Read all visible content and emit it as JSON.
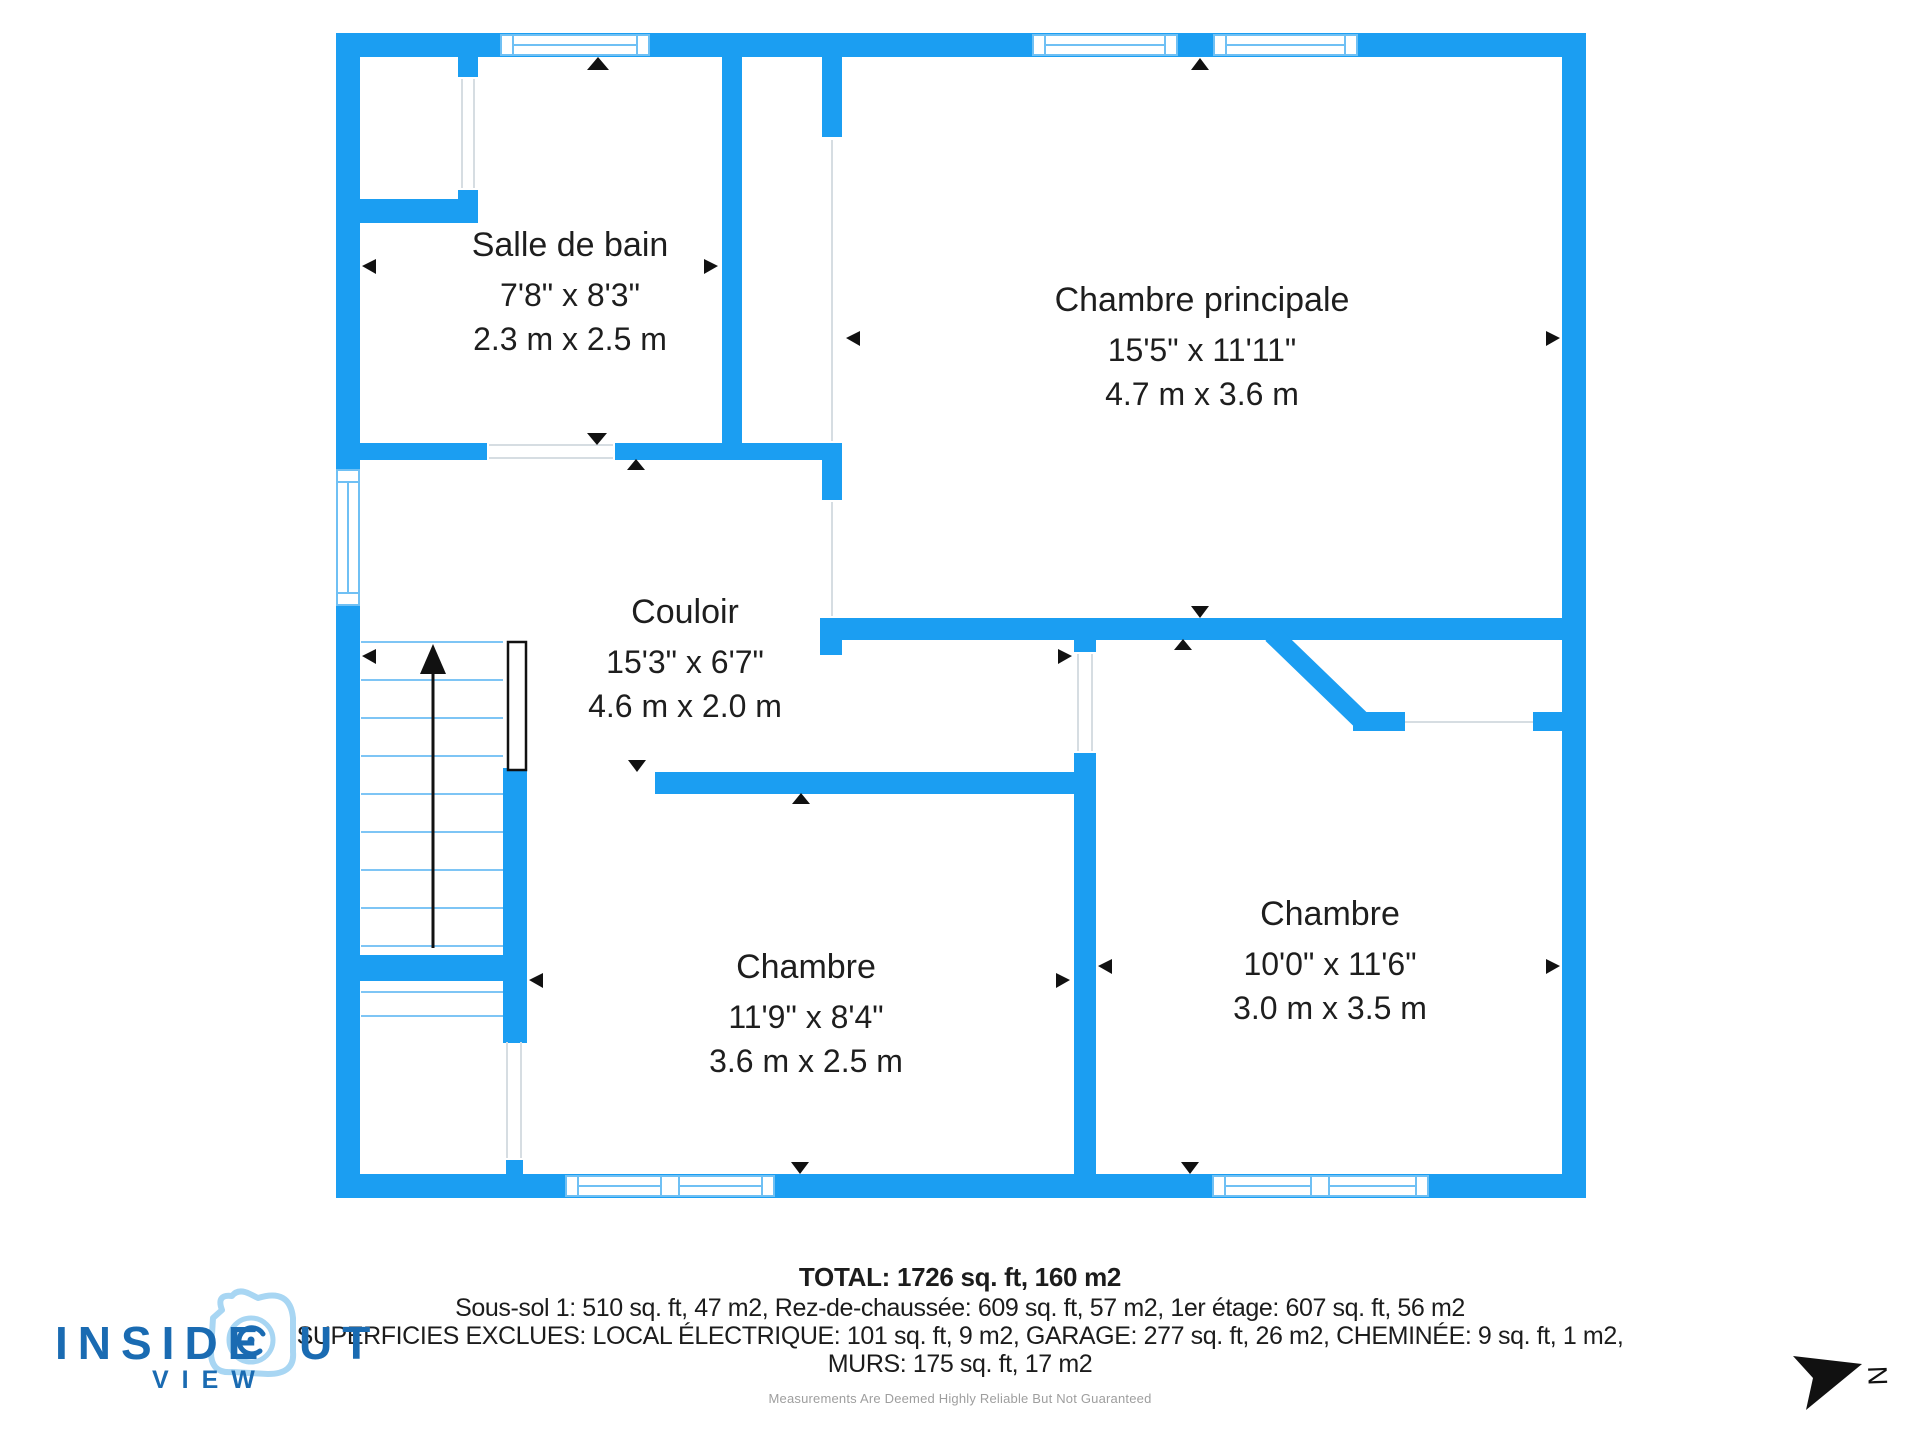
{
  "plan": {
    "rooms": [
      {
        "name": "Salle de bain",
        "imperial": "7'8\" x 8'3\"",
        "metric": "2.3 m x 2.5 m"
      },
      {
        "name": "Chambre principale",
        "imperial": "15'5\" x 11'11\"",
        "metric": "4.7 m x 3.6 m"
      },
      {
        "name": "Couloir",
        "imperial": "15'3\" x 6'7\"",
        "metric": "4.6 m x 2.0 m"
      },
      {
        "name": "Chambre",
        "imperial": "11'9\" x 8'4\"",
        "metric": "3.6 m x 2.5 m"
      },
      {
        "name": "Chambre",
        "imperial": "10'0\" x 11'6\"",
        "metric": "3.0 m x 3.5 m"
      }
    ]
  },
  "footer": {
    "total": "TOTAL: 1726 sq. ft, 160 m2",
    "levels": "Sous-sol 1: 510 sq. ft, 47 m2, Rez-de-chaussée: 609 sq. ft, 57 m2, 1er étage: 607 sq. ft, 56 m2",
    "excluded": "SUPERFICIES EXCLUES: LOCAL ÉLECTRIQUE: 101 sq. ft, 9 m2, GARAGE: 277 sq. ft, 26 m2, CHEMINÉE: 9 sq. ft, 1 m2,",
    "walls": "MURS: 175 sq. ft, 17 m2",
    "disclaimer": "Measurements Are Deemed Highly Reliable But Not Guaranteed"
  },
  "logo": {
    "part1": "INSIDE",
    "part2": "UT",
    "sub": "VIEW"
  },
  "compass": {
    "label": "N"
  },
  "colors": {
    "wall": "#1b9ef2",
    "winline": "#6fc0f4",
    "tread": "#7ec5f5",
    "thin": "#d6dde2",
    "ink": "#111111",
    "logodark": "#1a6bb2",
    "logolight": "#a8d6f3"
  }
}
